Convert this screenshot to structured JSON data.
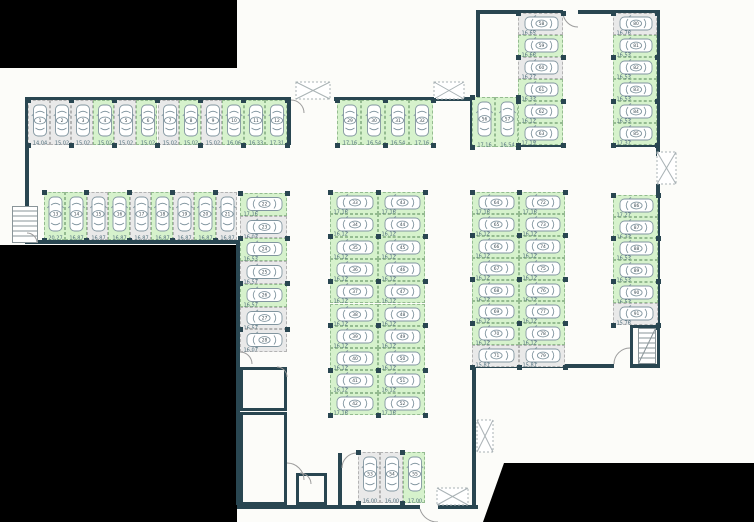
{
  "plan": {
    "name": "parking-garage-floor-plan",
    "total_stalls": 91
  },
  "colors": {
    "wall": "#294651",
    "available_fill": "#d6f2cc",
    "available_border": "#94bb90",
    "occupied_fill": "#e9e9e9",
    "occupied_border": "#b3b3b3",
    "car_stroke": "#8296a0",
    "dim_text": "#51707d",
    "number_text": "#3a4a52",
    "outside": "#000000",
    "background": "#fcfcf9",
    "door": "#9b9b9b",
    "shaft": "#a9b2b5",
    "stairs": "#8a9599"
  },
  "icons": {
    "car": "car-icon",
    "stairs": "stairs-icon",
    "vent_shaft": "vent-shaft-x-icon",
    "door": "door-arc-icon"
  },
  "blocks": [
    {
      "id": "top-row",
      "stalls": [
        {
          "n": "1",
          "dim": "14.04",
          "state": "occupied"
        },
        {
          "n": "2",
          "dim": "15.02",
          "state": "occupied"
        },
        {
          "n": "3",
          "dim": "15.02",
          "state": "occupied"
        },
        {
          "n": "4",
          "dim": "15.02",
          "state": "available"
        },
        {
          "n": "5",
          "dim": "15.02",
          "state": "occupied"
        },
        {
          "n": "6",
          "dim": "15.02",
          "state": "available"
        },
        {
          "n": "7",
          "dim": "15.02",
          "state": "occupied"
        },
        {
          "n": "8",
          "dim": "15.02",
          "state": "available"
        },
        {
          "n": "9",
          "dim": "15.02",
          "state": "occupied"
        },
        {
          "n": "10",
          "dim": "16.06",
          "state": "available"
        },
        {
          "n": "11",
          "dim": "16.33",
          "state": "available"
        },
        {
          "n": "12",
          "dim": "17.31",
          "state": "available"
        }
      ]
    },
    {
      "id": "mid-top-row",
      "stalls": [
        {
          "n": "29",
          "dim": "17.16",
          "state": "available"
        },
        {
          "n": "30",
          "dim": "16.54",
          "state": "available"
        },
        {
          "n": "31",
          "dim": "16.54",
          "state": "available"
        },
        {
          "n": "32",
          "dim": "17.16",
          "state": "available"
        }
      ]
    },
    {
      "id": "second-row",
      "stalls": [
        {
          "n": "13",
          "dim": "20.27",
          "state": "available"
        },
        {
          "n": "14",
          "dim": "16.87",
          "state": "available"
        },
        {
          "n": "15",
          "dim": "16.87",
          "state": "occupied"
        },
        {
          "n": "16",
          "dim": "16.87",
          "state": "available"
        },
        {
          "n": "17",
          "dim": "16.87",
          "state": "occupied"
        },
        {
          "n": "18",
          "dim": "16.87",
          "state": "available"
        },
        {
          "n": "19",
          "dim": "16.87",
          "state": "occupied"
        },
        {
          "n": "20",
          "dim": "16.87",
          "state": "available"
        },
        {
          "n": "21",
          "dim": "16.87",
          "state": "occupied"
        }
      ]
    },
    {
      "id": "left-column",
      "stalls": [
        {
          "n": "22",
          "dim": "17.16",
          "state": "available"
        },
        {
          "n": "23",
          "dim": "16.03",
          "state": "occupied"
        },
        {
          "n": "24",
          "dim": "16.53",
          "state": "available"
        },
        {
          "n": "25",
          "dim": "16.57",
          "state": "occupied"
        },
        {
          "n": "26",
          "dim": "16.57",
          "state": "available"
        },
        {
          "n": "27",
          "dim": "16.57",
          "state": "occupied"
        },
        {
          "n": "28",
          "dim": "16.07",
          "state": "occupied"
        }
      ]
    },
    {
      "id": "mid-col-left",
      "stalls": [
        {
          "n": "33",
          "dim": "17.16",
          "state": "available"
        },
        {
          "n": "34",
          "dim": "16.12",
          "state": "available"
        },
        {
          "n": "35",
          "dim": "16.12",
          "state": "available"
        },
        {
          "n": "36",
          "dim": "16.12",
          "state": "available"
        },
        {
          "n": "37",
          "dim": "16.12",
          "state": "available"
        },
        {
          "n": "38",
          "dim": "16.12",
          "state": "available"
        },
        {
          "n": "39",
          "dim": "16.12",
          "state": "available"
        },
        {
          "n": "40",
          "dim": "16.12",
          "state": "available"
        },
        {
          "n": "41",
          "dim": "16.12",
          "state": "available"
        },
        {
          "n": "42",
          "dim": "17.16",
          "state": "available"
        }
      ]
    },
    {
      "id": "mid-col-right",
      "stalls": [
        {
          "n": "43",
          "dim": "17.16",
          "state": "available"
        },
        {
          "n": "44",
          "dim": "16.12",
          "state": "available"
        },
        {
          "n": "45",
          "dim": "16.12",
          "state": "available"
        },
        {
          "n": "46",
          "dim": "16.12",
          "state": "available"
        },
        {
          "n": "47",
          "dim": "16.12",
          "state": "available"
        },
        {
          "n": "48",
          "dim": "16.12",
          "state": "available"
        },
        {
          "n": "49",
          "dim": "16.12",
          "state": "available"
        },
        {
          "n": "50",
          "dim": "16.12",
          "state": "available"
        },
        {
          "n": "51",
          "dim": "16.12",
          "state": "available"
        },
        {
          "n": "52",
          "dim": "17.16",
          "state": "available"
        }
      ]
    },
    {
      "id": "bottom-center",
      "stalls": [
        {
          "n": "53",
          "dim": "16.00",
          "state": "occupied"
        },
        {
          "n": "54",
          "dim": "16.00",
          "state": "occupied"
        },
        {
          "n": "55",
          "dim": "17.00",
          "state": "available"
        }
      ]
    },
    {
      "id": "pair-56-57",
      "stalls": [
        {
          "n": "56",
          "dim": "17.16",
          "state": "available"
        },
        {
          "n": "57",
          "dim": "16.54",
          "state": "available"
        }
      ]
    },
    {
      "id": "upper-col-58-63",
      "stalls": [
        {
          "n": "58",
          "dim": "16.65",
          "state": "occupied"
        },
        {
          "n": "59",
          "dim": "16.66",
          "state": "available"
        },
        {
          "n": "60",
          "dim": "16.27",
          "state": "occupied"
        },
        {
          "n": "61",
          "dim": "16.33",
          "state": "available"
        },
        {
          "n": "62",
          "dim": "16.12",
          "state": "available"
        },
        {
          "n": "63",
          "dim": "17.19",
          "state": "available"
        }
      ]
    },
    {
      "id": "right-col-64-71",
      "stalls": [
        {
          "n": "64",
          "dim": "17.16",
          "state": "available"
        },
        {
          "n": "65",
          "dim": "16.12",
          "state": "available"
        },
        {
          "n": "66",
          "dim": "16.12",
          "state": "available"
        },
        {
          "n": "67",
          "dim": "16.12",
          "state": "available"
        },
        {
          "n": "68",
          "dim": "16.12",
          "state": "available"
        },
        {
          "n": "69",
          "dim": "16.12",
          "state": "available"
        },
        {
          "n": "70",
          "dim": "16.12",
          "state": "available"
        },
        {
          "n": "71",
          "dim": "15.81",
          "state": "occupied"
        }
      ]
    },
    {
      "id": "right-col-72-79",
      "stalls": [
        {
          "n": "72",
          "dim": "17.16",
          "state": "available"
        },
        {
          "n": "73",
          "dim": "16.12",
          "state": "available"
        },
        {
          "n": "74",
          "dim": "16.12",
          "state": "available"
        },
        {
          "n": "75",
          "dim": "16.12",
          "state": "available"
        },
        {
          "n": "76",
          "dim": "16.12",
          "state": "available"
        },
        {
          "n": "77",
          "dim": "16.12",
          "state": "available"
        },
        {
          "n": "78",
          "dim": "16.12",
          "state": "available"
        },
        {
          "n": "79",
          "dim": "15.81",
          "state": "occupied"
        }
      ]
    },
    {
      "id": "topright-col-80-85",
      "stalls": [
        {
          "n": "80",
          "dim": "16.76",
          "state": "occupied"
        },
        {
          "n": "81",
          "dim": "16.53",
          "state": "available"
        },
        {
          "n": "82",
          "dim": "16.53",
          "state": "available"
        },
        {
          "n": "83",
          "dim": "16.53",
          "state": "available"
        },
        {
          "n": "84",
          "dim": "16.53",
          "state": "available"
        },
        {
          "n": "85",
          "dim": "17.37",
          "state": "available"
        }
      ]
    },
    {
      "id": "far-right-col-86-91",
      "stalls": [
        {
          "n": "86",
          "dim": "17.27",
          "state": "available"
        },
        {
          "n": "87",
          "dim": "16.33",
          "state": "available"
        },
        {
          "n": "88",
          "dim": "16.53",
          "state": "available"
        },
        {
          "n": "89",
          "dim": "16.53",
          "state": "available"
        },
        {
          "n": "90",
          "dim": "16.53",
          "state": "available"
        },
        {
          "n": "91",
          "dim": "15.76",
          "state": "occupied"
        }
      ]
    }
  ]
}
